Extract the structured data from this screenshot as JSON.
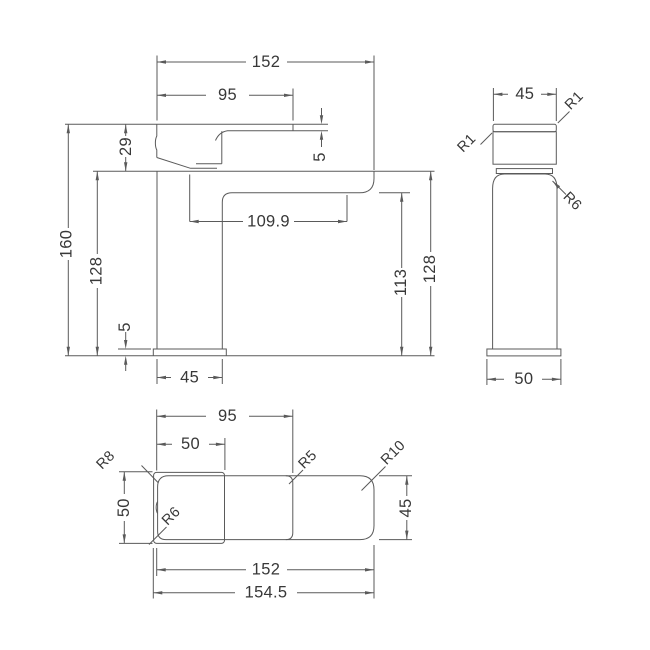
{
  "views": {
    "front": {
      "total_width": "152",
      "handle_length": "95",
      "head_height": "29",
      "handle_thickness": "5",
      "overall_height": "160",
      "height_left": "128",
      "spout_reach": "109.9",
      "spout_underside_height": "113",
      "height_right": "128",
      "base_thickness": "5",
      "body_width": "45"
    },
    "side": {
      "body_depth": "45",
      "radius_back": "R1",
      "radius_front": "R1",
      "radius_shoulder": "R6",
      "base_depth": "50"
    },
    "top": {
      "handle_length": "95",
      "base_length": "50",
      "radius_rear_left": "R8",
      "radius_mid": "R5",
      "radius_spout_end": "R10",
      "base_width": "50",
      "radius_front_left": "R6",
      "body_depth": "45",
      "body_length": "152",
      "overall_length": "154.5"
    }
  },
  "colors": {
    "line": "#5a5a5a",
    "text": "#383838",
    "background": "#ffffff"
  }
}
